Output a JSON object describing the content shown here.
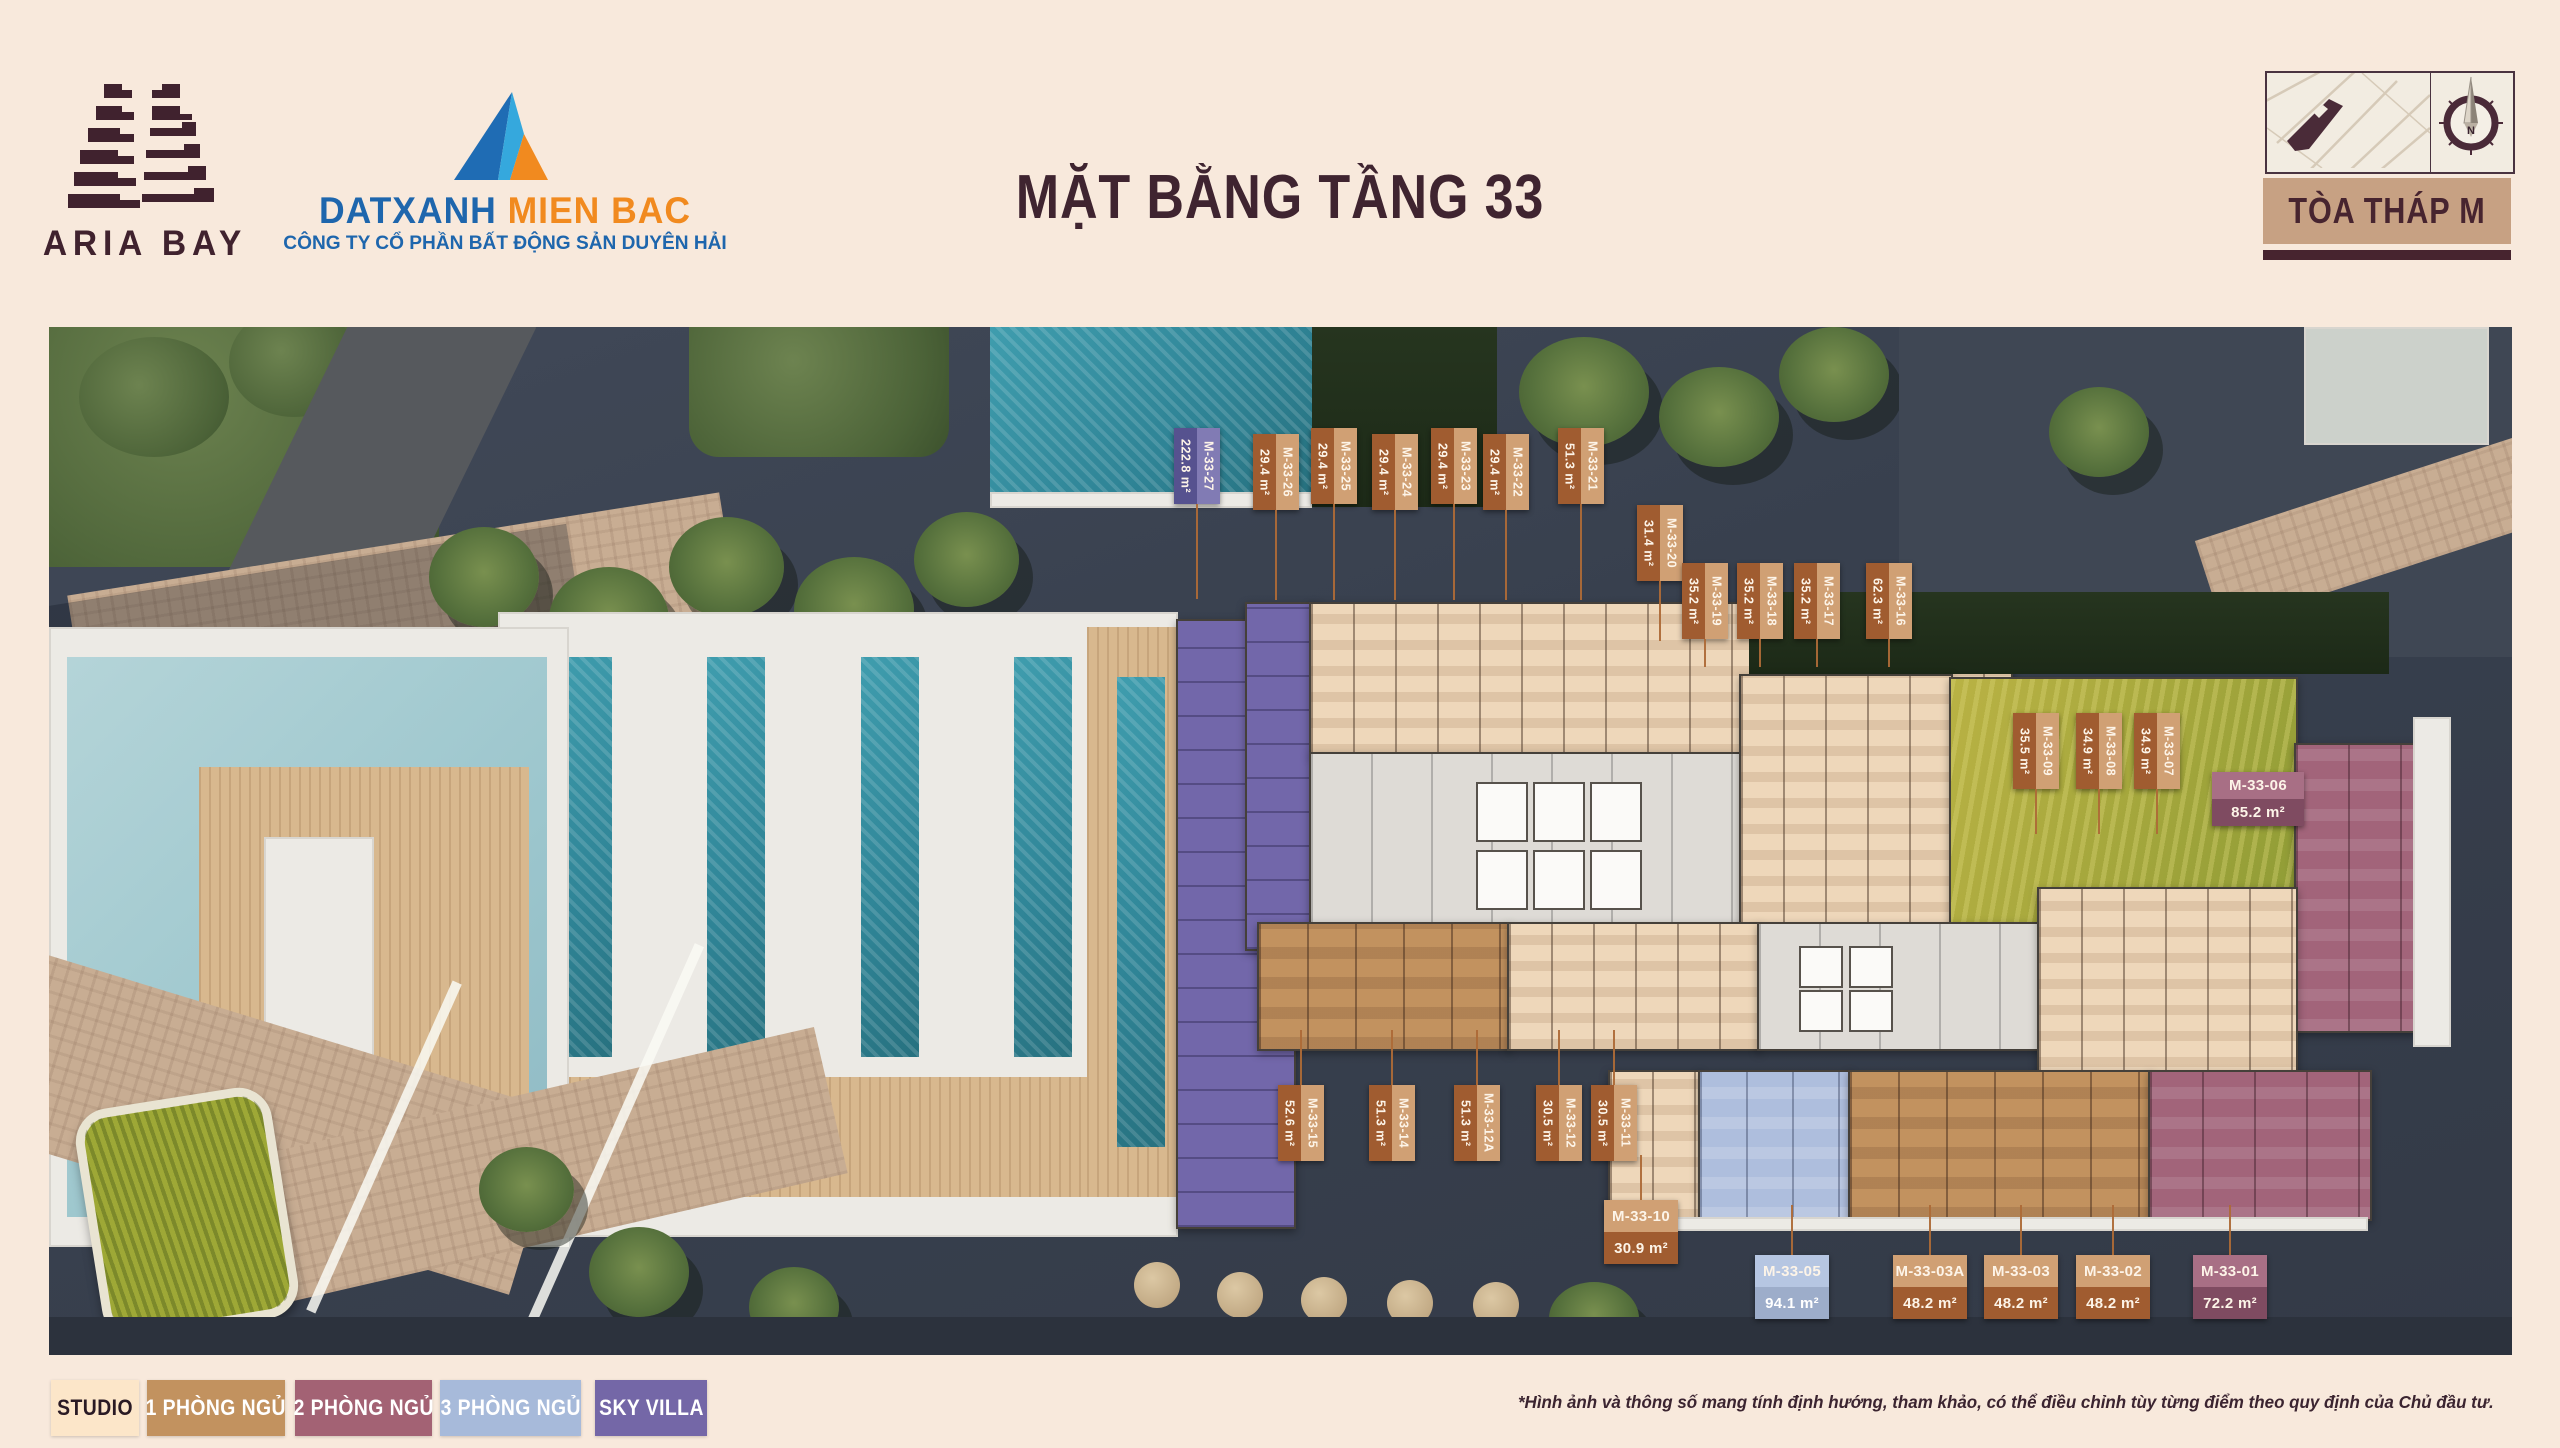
{
  "header": {
    "brand": "ARIA BAY",
    "agency_name_primary": "DATXANH",
    "agency_name_secondary": " MIEN BAC",
    "agency_company": "CÔNG TY CỔ PHẦN BẤT ĐỘNG SẢN DUYÊN HẢI",
    "title": "MẶT BẰNG TẦNG 33",
    "tower_chip": "TÒA THÁP M",
    "compass_north": "N"
  },
  "legend": {
    "items": [
      {
        "label": "STUDIO",
        "bg": "#fce6c9",
        "fg": "#2a1a24",
        "x": 51,
        "w": 88
      },
      {
        "label": "1 PHÒNG NGỦ",
        "bg": "#c2925f",
        "fg": "#ffffff",
        "x": 147,
        "w": 138
      },
      {
        "label": "2 PHÒNG NGỦ",
        "bg": "#a36274",
        "fg": "#ffffff",
        "x": 295,
        "w": 137
      },
      {
        "label": "3 PHÒNG NGỦ",
        "bg": "#a7bada",
        "fg": "#ffffff",
        "x": 440,
        "w": 141
      },
      {
        "label": "SKY VILLA",
        "bg": "#7467a7",
        "fg": "#ffffff",
        "x": 595,
        "w": 112
      }
    ],
    "y": 1380,
    "h": 56
  },
  "disclaimer": "*Hình ảnh và thông số mang tính định hướng, tham khảo, có thể điều chỉnh tùy từng điểm theo quy định của Chủ đầu tư.",
  "label_styles": {
    "brown": {
      "dark": "#a05c30",
      "light": "#d0a074"
    },
    "purple": {
      "dark": "#56528f",
      "light": "#817bb4"
    },
    "mauve": {
      "dark": "#7f4b61",
      "light": "#a86f85"
    },
    "blue": {
      "dark": "#9dadca",
      "light": "#b6c6e2"
    }
  },
  "units": [
    {
      "id": "M-33-27",
      "area": "222.8 m²",
      "style": "purple",
      "orient": "v",
      "x": 1174,
      "y": 428,
      "leader": "down",
      "len": 95
    },
    {
      "id": "M-33-26",
      "area": "29.4 m²",
      "style": "brown",
      "orient": "v",
      "x": 1253,
      "y": 434,
      "leader": "down",
      "len": 90
    },
    {
      "id": "M-33-25",
      "area": "29.4 m²",
      "style": "brown",
      "orient": "v",
      "x": 1311,
      "y": 428,
      "leader": "down",
      "len": 96
    },
    {
      "id": "M-33-24",
      "area": "29.4 m²",
      "style": "brown",
      "orient": "v",
      "x": 1372,
      "y": 434,
      "leader": "down",
      "len": 90
    },
    {
      "id": "M-33-23",
      "area": "29.4 m²",
      "style": "brown",
      "orient": "v",
      "x": 1431,
      "y": 428,
      "leader": "down",
      "len": 96
    },
    {
      "id": "M-33-22",
      "area": "29.4 m²",
      "style": "brown",
      "orient": "v",
      "x": 1483,
      "y": 434,
      "leader": "down",
      "len": 90
    },
    {
      "id": "M-33-21",
      "area": "51.3 m²",
      "style": "brown",
      "orient": "v",
      "x": 1558,
      "y": 428,
      "leader": "down",
      "len": 96
    },
    {
      "id": "M-33-20",
      "area": "31.4 m²",
      "style": "brown",
      "orient": "v",
      "x": 1637,
      "y": 505,
      "leader": "down",
      "len": 60
    },
    {
      "id": "M-33-19",
      "area": "35.2 m²",
      "style": "brown",
      "orient": "v",
      "x": 1682,
      "y": 563,
      "leader": "down",
      "len": 28
    },
    {
      "id": "M-33-18",
      "area": "35.2 m²",
      "style": "brown",
      "orient": "v",
      "x": 1737,
      "y": 563,
      "leader": "down",
      "len": 28
    },
    {
      "id": "M-33-17",
      "area": "35.2 m²",
      "style": "brown",
      "orient": "v",
      "x": 1794,
      "y": 563,
      "leader": "down",
      "len": 28
    },
    {
      "id": "M-33-16",
      "area": "62.3 m²",
      "style": "brown",
      "orient": "v",
      "x": 1866,
      "y": 563,
      "leader": "down",
      "len": 28
    },
    {
      "id": "M-33-09",
      "area": "35.5 m²",
      "style": "brown",
      "orient": "v",
      "x": 2013,
      "y": 713,
      "leader": "down",
      "len": 45
    },
    {
      "id": "M-33-08",
      "area": "34.9 m²",
      "style": "brown",
      "orient": "v",
      "x": 2076,
      "y": 713,
      "leader": "down",
      "len": 45
    },
    {
      "id": "M-33-07",
      "area": "34.9 m²",
      "style": "brown",
      "orient": "v",
      "x": 2134,
      "y": 713,
      "leader": "down",
      "len": 45
    },
    {
      "id": "M-33-06",
      "area": "85.2 m²",
      "style": "mauve",
      "orient": "h",
      "x": 2212,
      "y": 772,
      "leader": "none",
      "len": 0,
      "w": 92,
      "h": 54
    },
    {
      "id": "M-33-15",
      "area": "52.6 m²",
      "style": "brown",
      "orient": "v",
      "x": 1278,
      "y": 1085,
      "leader": "up",
      "len": 55
    },
    {
      "id": "M-33-14",
      "area": "51.3 m²",
      "style": "brown",
      "orient": "v",
      "x": 1369,
      "y": 1085,
      "leader": "up",
      "len": 55
    },
    {
      "id": "M-33-12A",
      "area": "51.3 m²",
      "style": "brown",
      "orient": "v",
      "x": 1454,
      "y": 1085,
      "leader": "up",
      "len": 55
    },
    {
      "id": "M-33-12",
      "area": "30.5 m²",
      "style": "brown",
      "orient": "v",
      "x": 1536,
      "y": 1085,
      "leader": "up",
      "len": 55
    },
    {
      "id": "M-33-11",
      "area": "30.5 m²",
      "style": "brown",
      "orient": "v",
      "x": 1591,
      "y": 1085,
      "leader": "up",
      "len": 55
    },
    {
      "id": "M-33-10",
      "area": "30.9 m²",
      "style": "brown",
      "orient": "h",
      "x": 1604,
      "y": 1200,
      "leader": "up",
      "len": 45
    },
    {
      "id": "M-33-05",
      "area": "94.1 m²",
      "style": "blue",
      "orient": "h",
      "x": 1755,
      "y": 1255,
      "leader": "up",
      "len": 50
    },
    {
      "id": "M-33-03A",
      "area": "48.2 m²",
      "style": "brown",
      "orient": "h",
      "x": 1893,
      "y": 1255,
      "leader": "up",
      "len": 50
    },
    {
      "id": "M-33-03",
      "area": "48.2 m²",
      "style": "brown",
      "orient": "h",
      "x": 1984,
      "y": 1255,
      "leader": "up",
      "len": 50
    },
    {
      "id": "M-33-02",
      "area": "48.2 m²",
      "style": "brown",
      "orient": "h",
      "x": 2076,
      "y": 1255,
      "leader": "up",
      "len": 50
    },
    {
      "id": "M-33-01",
      "area": "72.2 m²",
      "style": "mauve",
      "orient": "h",
      "x": 2193,
      "y": 1255,
      "leader": "up",
      "len": 50
    }
  ]
}
